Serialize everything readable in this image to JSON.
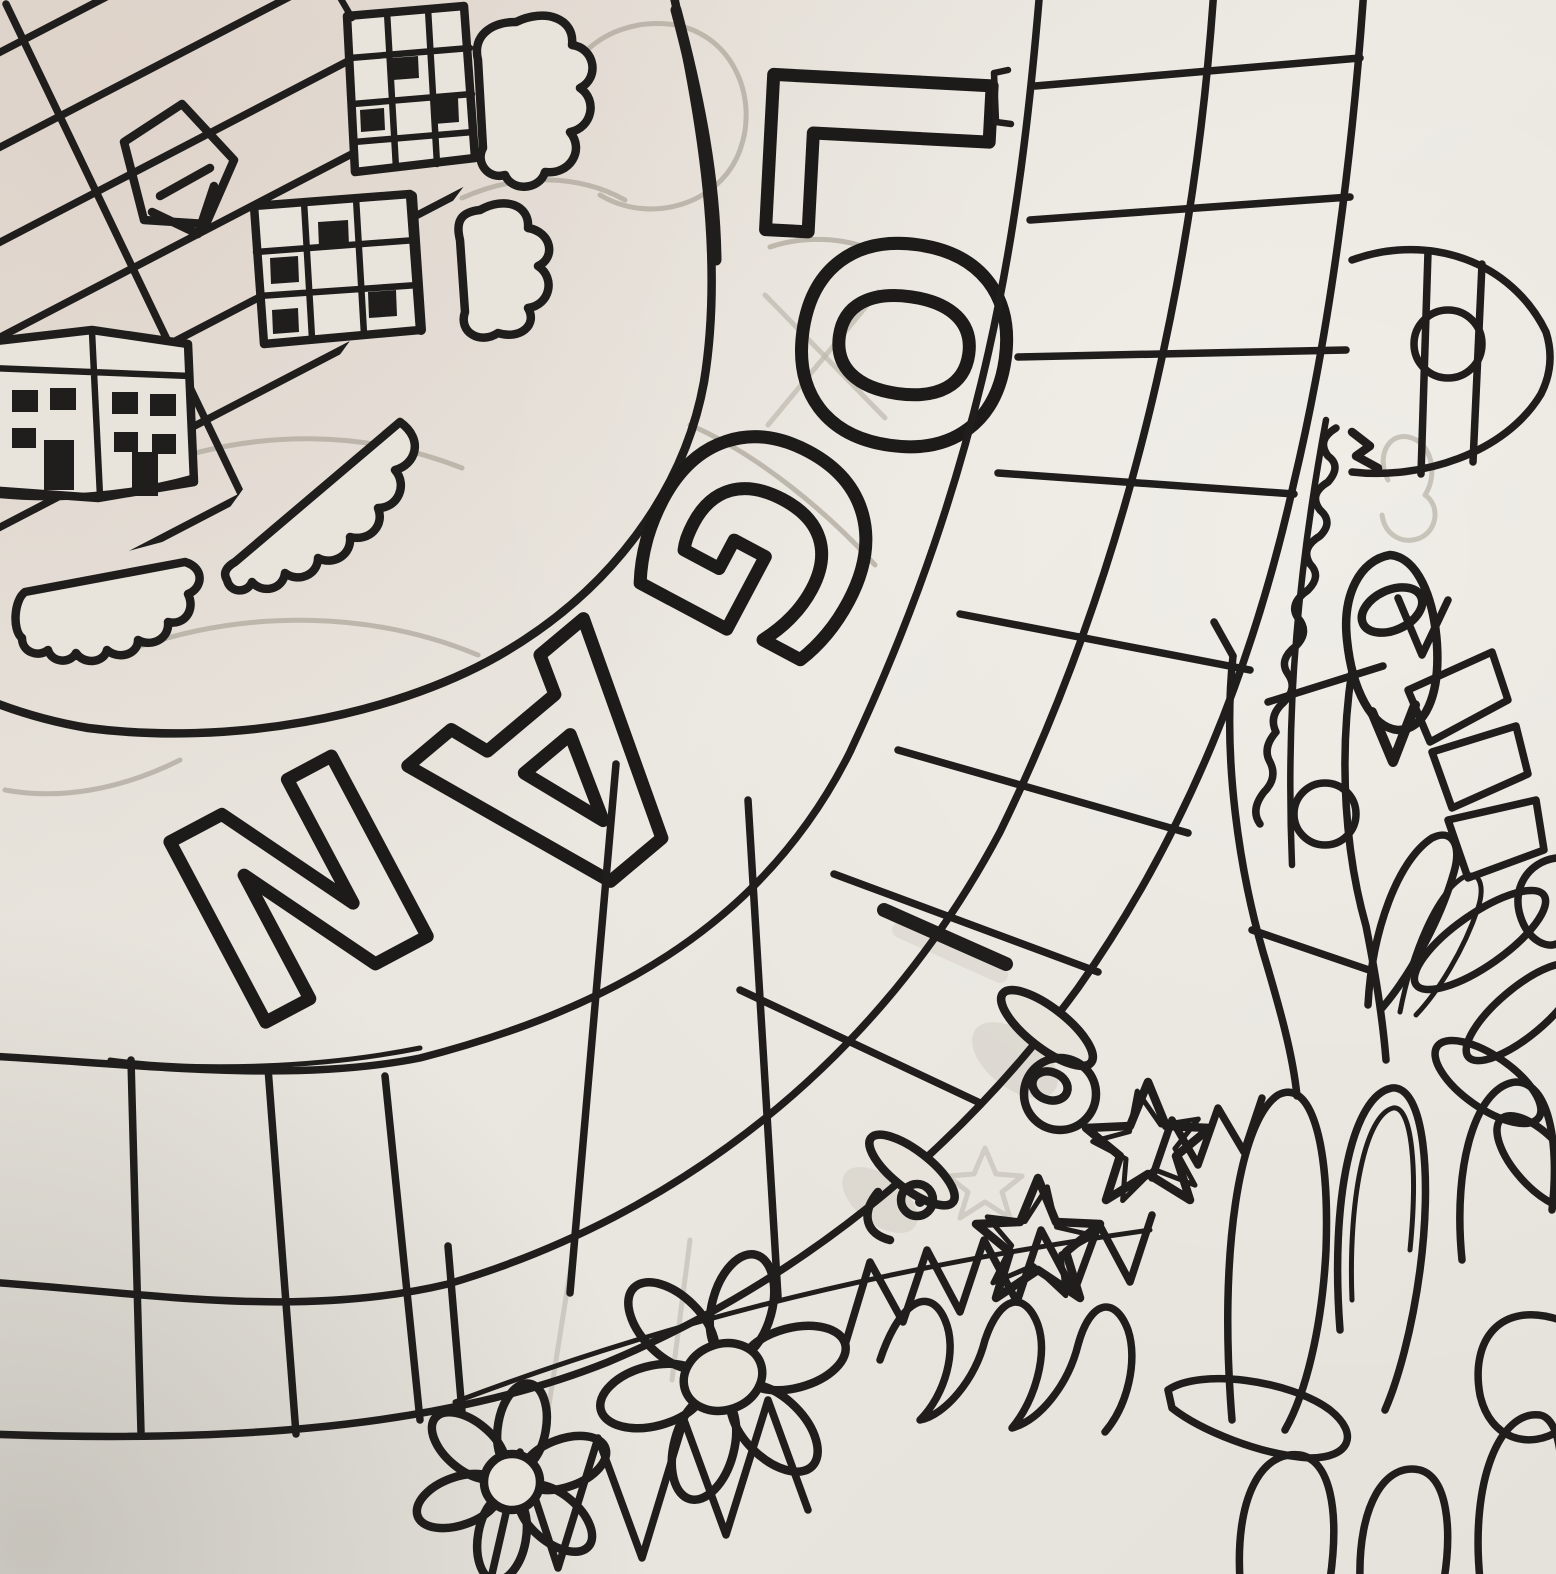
{
  "meta": {
    "description": "Photograph of a child's black-marker drawing: a circular board-game style map with houses, clouds, a curved grid track, roads with roundabouts, flowers, stars, grass and loop doodles"
  },
  "art": {
    "word": "LOGAN",
    "letters": [
      "L",
      "O",
      "G",
      "A",
      "N"
    ],
    "colors": {
      "paper": "#e8e4dc",
      "ink": "#201e1c",
      "pencil": "#b2aca1"
    },
    "motifs": [
      "striped-field",
      "houses",
      "clouds",
      "curved-grid-track",
      "roundabout-roads",
      "zigzag-grass",
      "daisy-flowers",
      "stars",
      "loop-scribbles",
      "wheel-doodles",
      "rocket-doodle"
    ]
  }
}
